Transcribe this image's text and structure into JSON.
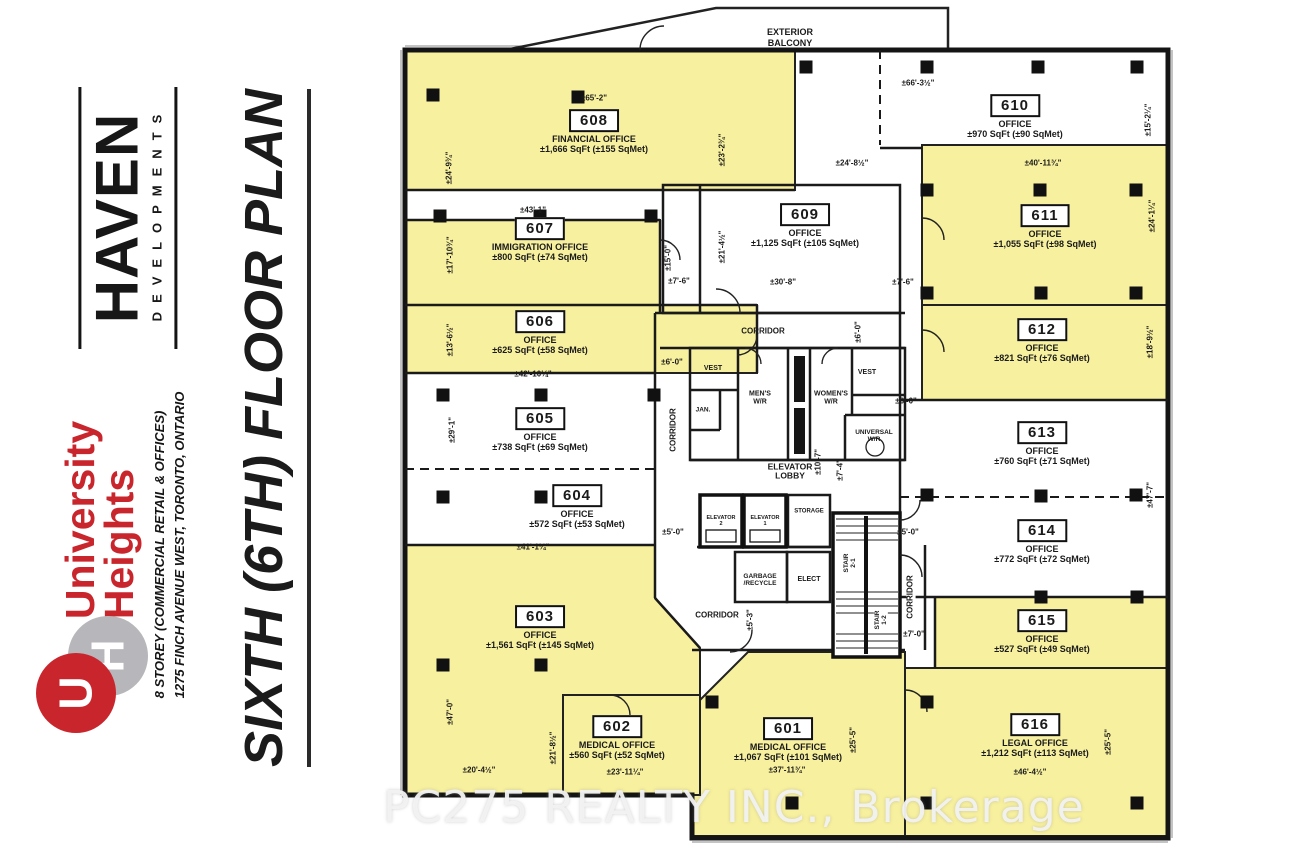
{
  "sidebar": {
    "developer_logo": {
      "word": "HAVEN",
      "sub": "DEVELOPMENTS"
    },
    "project_name": {
      "line1": "University",
      "line2": "Heights"
    },
    "address_line1": "8 STOREY (COMMERCIAL RETAIL & OFFICES)",
    "address_line2": "1275 FINCH AVENUE WEST, TORONTO, ONTARIO",
    "uh_monogram": {
      "u": "U",
      "h": "H"
    },
    "plan_title": "SIXTH (6TH) FLOOR PLAN"
  },
  "watermark": {
    "text": "PC275 REALTY INC., Brokerage"
  },
  "plan": {
    "balcony_label": "EXTERIOR\nBALCONY",
    "colors": {
      "room_highlight": "#f7f09e",
      "wall": "#1a1a1a",
      "logo_red": "#c9252c",
      "logo_gray": "#b7b7bb"
    },
    "rooms": [
      {
        "number": "601",
        "type": "MEDICAL OFFICE",
        "area": "±1,067 SqFt (±101 SqMet)",
        "highlighted": true
      },
      {
        "number": "602",
        "type": "MEDICAL OFFICE",
        "area": "±560 SqFt (±52 SqMet)",
        "highlighted": true
      },
      {
        "number": "603",
        "type": "OFFICE",
        "area": "±1,561 SqFt (±145 SqMet)",
        "highlighted": true
      },
      {
        "number": "604",
        "type": "OFFICE",
        "area": "±572 SqFt (±53 SqMet)",
        "highlighted": false
      },
      {
        "number": "605",
        "type": "OFFICE",
        "area": "±738 SqFt (±69 SqMet)",
        "highlighted": false
      },
      {
        "number": "606",
        "type": "OFFICE",
        "area": "±625 SqFt (±58 SqMet)",
        "highlighted": true
      },
      {
        "number": "607",
        "type": "IMMIGRATION OFFICE",
        "area": "±800 SqFt (±74 SqMet)",
        "highlighted": true
      },
      {
        "number": "608",
        "type": "FINANCIAL OFFICE",
        "area": "±1,666 SqFt (±155 SqMet)",
        "highlighted": true
      },
      {
        "number": "609",
        "type": "OFFICE",
        "area": "±1,125 SqFt (±105 SqMet)",
        "highlighted": false
      },
      {
        "number": "610",
        "type": "OFFICE",
        "area": "±970 SqFt (±90 SqMet)",
        "highlighted": false
      },
      {
        "number": "611",
        "type": "OFFICE",
        "area": "±1,055 SqFt (±98 SqMet)",
        "highlighted": true
      },
      {
        "number": "612",
        "type": "OFFICE",
        "area": "±821 SqFt (±76 SqMet)",
        "highlighted": true
      },
      {
        "number": "613",
        "type": "OFFICE",
        "area": "±760 SqFt (±71 SqMet)",
        "highlighted": false
      },
      {
        "number": "614",
        "type": "OFFICE",
        "area": "±772 SqFt (±72 SqMet)",
        "highlighted": false
      },
      {
        "number": "615",
        "type": "OFFICE",
        "area": "±527 SqFt (±49 SqMet)",
        "highlighted": true
      },
      {
        "number": "616",
        "type": "LEGAL OFFICE",
        "area": "±1,212 SqFt (±113 SqMet)",
        "highlighted": true
      }
    ],
    "core_labels": [
      "CORRIDOR",
      "CORRIDOR",
      "CORRIDOR",
      "CORRIDOR",
      "VEST",
      "VEST",
      "JAN.",
      "MEN'S\nW/R",
      "WOMEN'S\nW/R",
      "UNIVERSAL\nW/R",
      "ELEVATOR\nLOBBY",
      "ELEVATOR\n2",
      "ELEVATOR\n1",
      "STORAGE",
      "GARBAGE\n/RECYCLE",
      "ELECT",
      "STAIR\n2-1",
      "STAIR\n1-2"
    ],
    "dimensions": [
      "±65'-2\"",
      "±24'-9¾\"",
      "±23'-2¾\"",
      "±66'-3½\"",
      "±15'-2¼\"",
      "±24'-8½\"",
      "±40'-11¾\"",
      "±24'-1¼\"",
      "±43'-1\"",
      "±17'-10¾\"",
      "±15'-0\"",
      "±21'-4½\"",
      "±7'-6\"",
      "±30'-8\"",
      "±7'-6\"",
      "±13'-6½\"",
      "±6'-0\"",
      "±42'-10¼\"",
      "±6'-0\"",
      "±6'-0\"",
      "±18'-9½\"",
      "±29'-1\"",
      "±10'-7\"",
      "±7'-4\"",
      "±5'-0\"",
      "±5'-0\"",
      "±41'-1¼\"",
      "±47'-7\"",
      "±5'-3\"",
      "±7'-0\"",
      "±47'-0\"",
      "±20'-4½\"",
      "±21'-8½\"",
      "±23'-11¼\"",
      "±37'-11¾\"",
      "±25'-5\"",
      "±46'-4½\"",
      "±25'-5\""
    ]
  }
}
